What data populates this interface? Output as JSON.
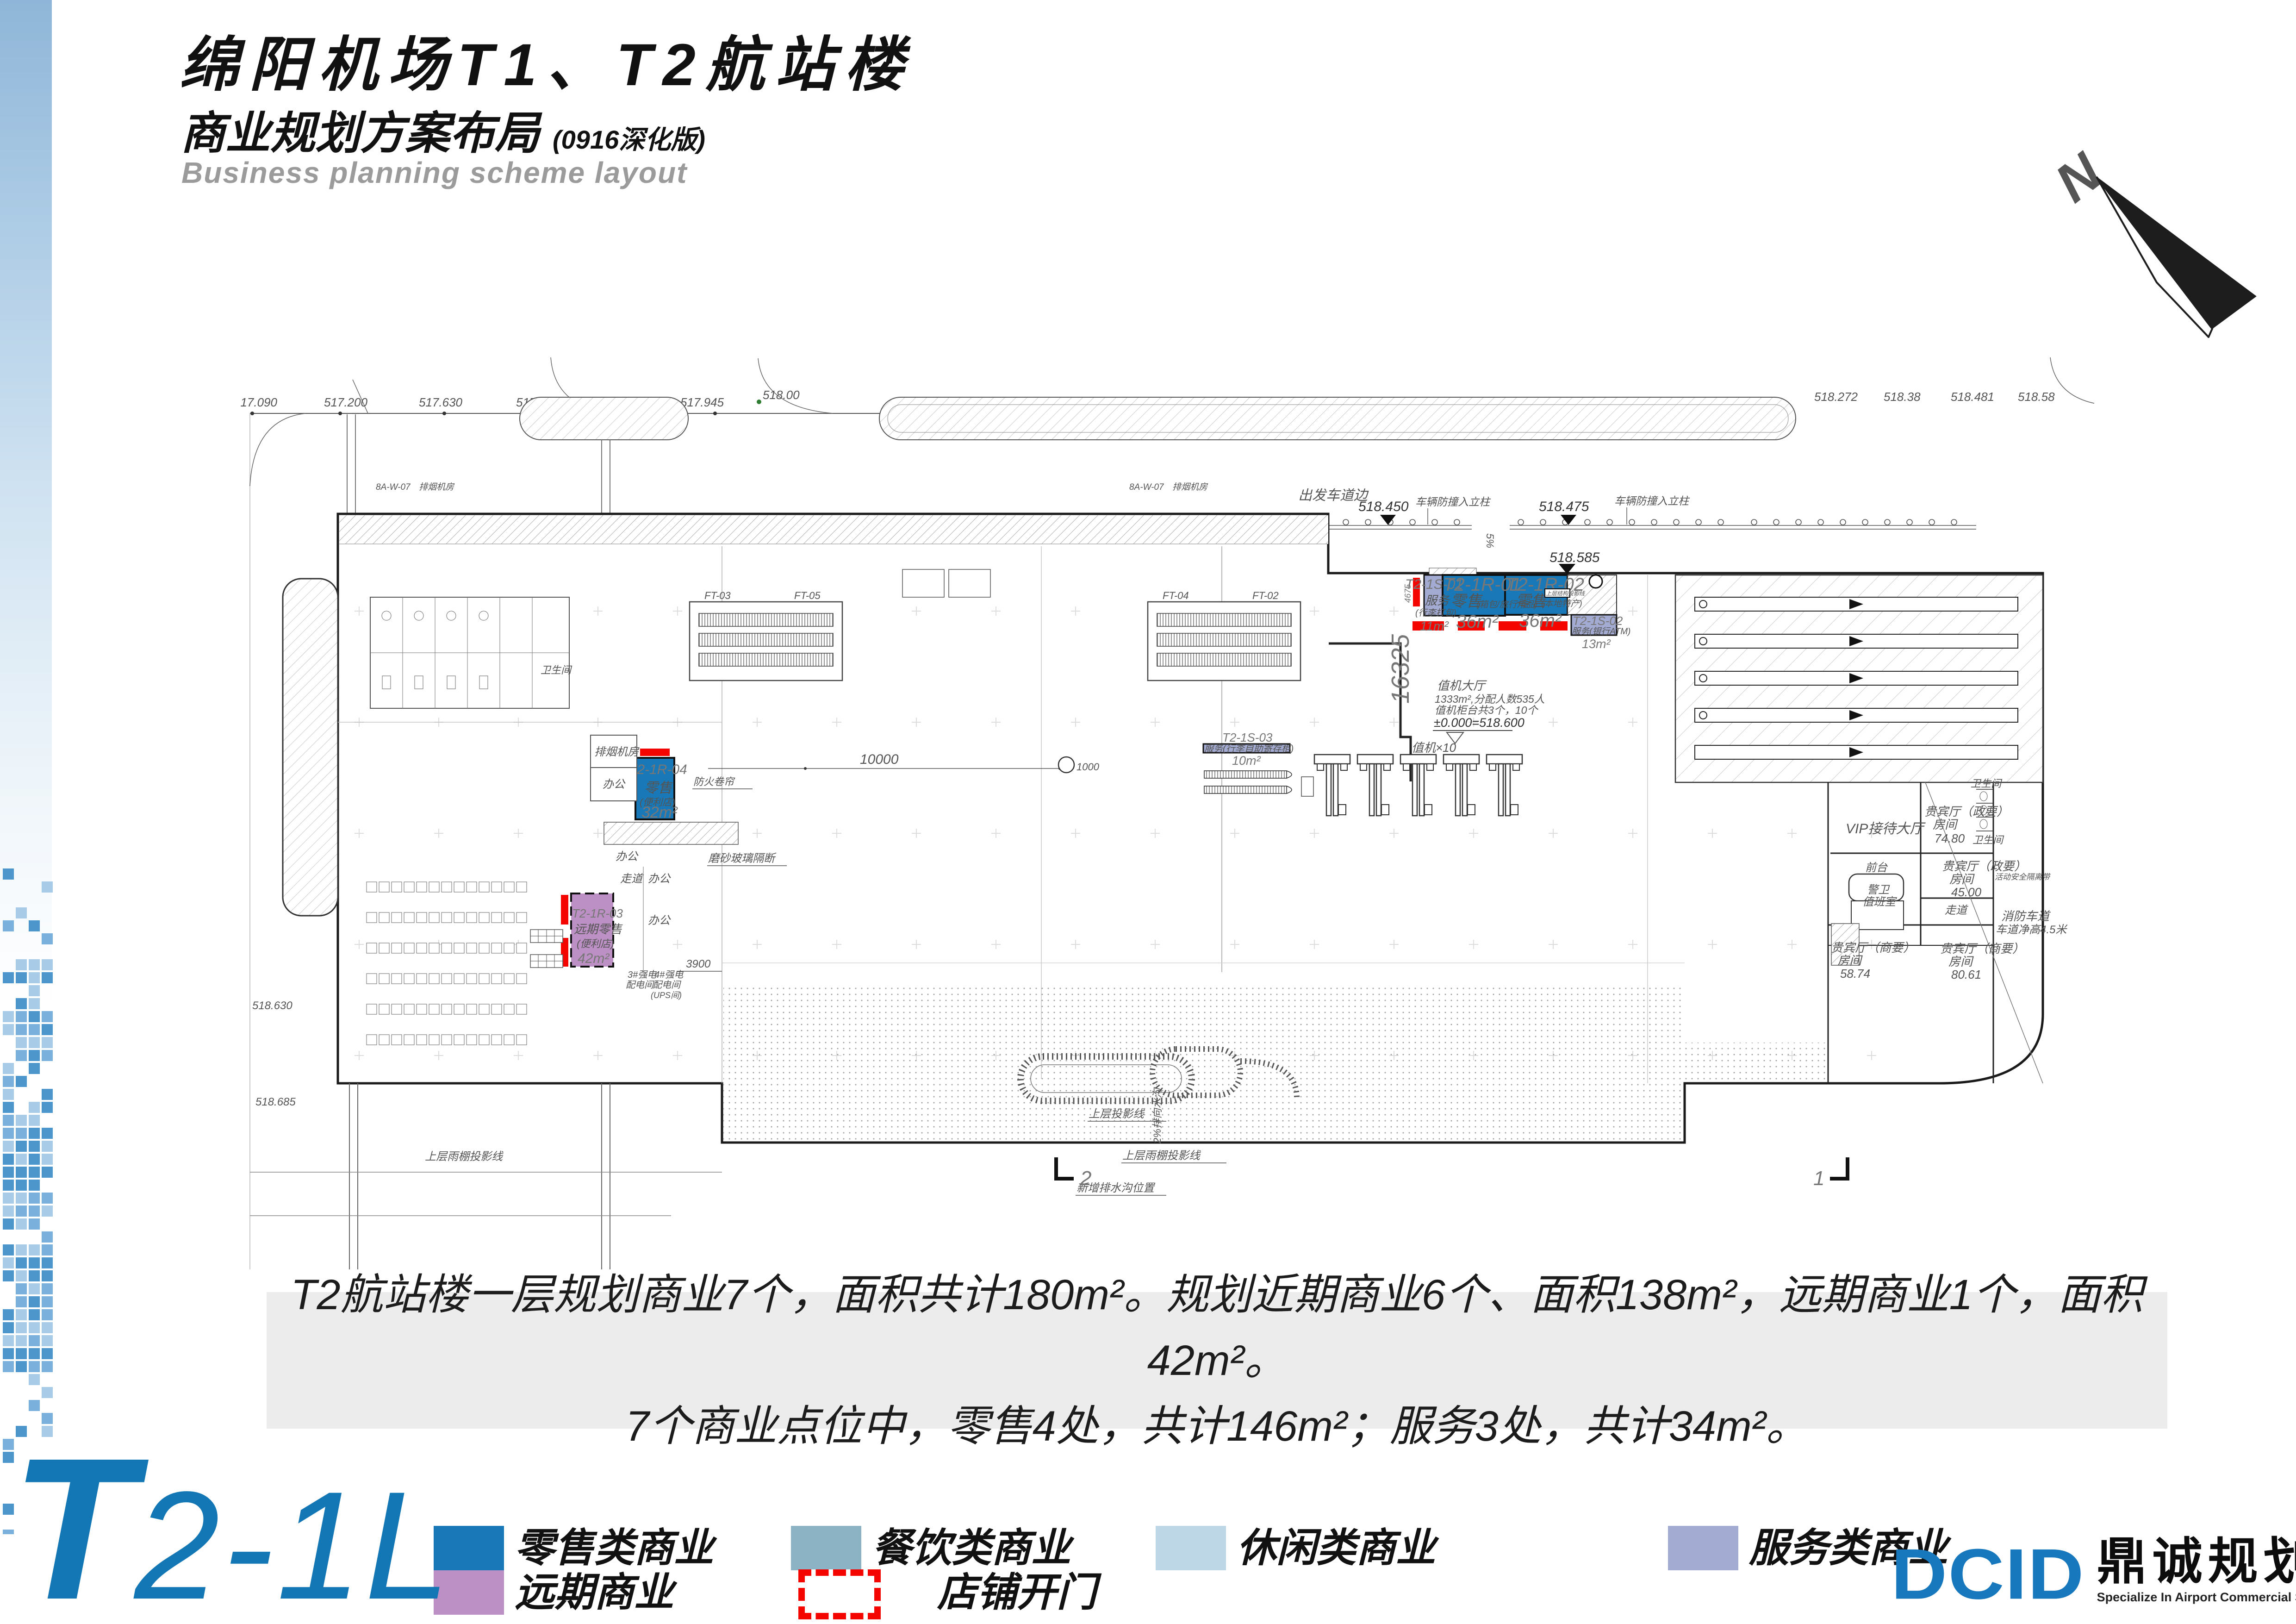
{
  "header": {
    "title": "绵阳机场T1、T2航站楼",
    "subtitle": "商业规划方案布局",
    "subtitle_note": "(0916深化版)",
    "subtitle_en": "Business planning scheme layout",
    "north_label": "N"
  },
  "summary": {
    "line1": "T2航站楼一层规划商业7个，面积共计180m²。规划近期商业6个、面积138m²，远期商业1个，面积42m²。",
    "line2": "7个商业点位中，零售4处，共计146m²；服务3处，共计34m²。"
  },
  "colors": {
    "retail": "#1878B8",
    "dining": "#8CB3C4",
    "leisure": "#BDD7E6",
    "service": "#A3ABD2",
    "longterm": "#BC90C4",
    "open_red": "#F50500",
    "accent_blue": "#1477B5",
    "logo_blue": "#1878BE",
    "elev_green": "#2E7D32"
  },
  "legend": {
    "items": [
      {
        "key": "retail",
        "label": "零售类商业"
      },
      {
        "key": "dining",
        "label": "餐饮类商业"
      },
      {
        "key": "leisure",
        "label": "休闲类商业"
      },
      {
        "key": "service",
        "label": "服务类商业"
      },
      {
        "key": "longterm",
        "label": "远期商业"
      },
      {
        "key": "open",
        "label": "店铺开门"
      }
    ]
  },
  "footer": {
    "floor_code_big": "T",
    "floor_code_rest": "2-1L",
    "logo_text": "DCID",
    "logo_cn": "鼎诚规划设计",
    "logo_en": "Specialize In Airport Commercial Space Planning And Designing"
  },
  "plan": {
    "units": [
      {
        "id": "T2-1S-01",
        "cat": "service",
        "name": "服务",
        "sub": "(行李打包)",
        "area": "11m²"
      },
      {
        "id": "T2-1R-01",
        "cat": "retail",
        "name": "零售",
        "sub": "(箱包/旅行用品)",
        "area": "36m²"
      },
      {
        "id": "T2-1R-02",
        "cat": "retail",
        "name": "零售",
        "sub": "(本地特产)",
        "area": "36m²"
      },
      {
        "id": "T2-1S-02",
        "cat": "service",
        "name": "服务",
        "sub": "(银行ATM)",
        "area": "13m²"
      },
      {
        "id": "T2-1S-03",
        "cat": "service",
        "name": "服务",
        "sub": "(行李自助寄存柜)",
        "area": "10m²"
      },
      {
        "id": "T2-1R-04",
        "cat": "retail",
        "name": "零售",
        "sub": "(便利店)",
        "area": "32m²"
      },
      {
        "id": "T2-1R-03",
        "cat": "longterm",
        "name": "远期零售",
        "sub": "(便利店)",
        "area": "42m²"
      }
    ],
    "labels": {
      "elev_517_090": "517.090",
      "elev_517_200": "517.200",
      "elev_517_630": "517.630",
      "elev_517_735": "517.735",
      "elev_517_945": "517.945",
      "elev_518_00": "518.00",
      "elev_518_272": "518.272",
      "elev_518_38": "518.38",
      "elev_518_481": "518.481",
      "elev_518_58": "518.58",
      "elev_518_450": "518.450",
      "elev_518_475": "518.475",
      "elev_518_585": "518.585",
      "elev_518_630": "518.630",
      "elev_518_685": "518.685",
      "dim_16325": "16325",
      "dim_10000": "10000",
      "dim_3900": "3900",
      "dim_4675": "4675",
      "dim_1000": "1000",
      "dim_5pct": "5%",
      "curb": "出发车道边",
      "bollard": "车辆防撞入立柱",
      "fire_shutter": "防火卷帘",
      "glass": "磨砂玻璃隔断",
      "proj_line": "上层投影线",
      "canopy_proj": "上层雨棚投影线",
      "drain2": "2%排向水沟",
      "new_drain": "新增排水沟位置",
      "level0": "±0.000=518.600",
      "checkin_hall": "值机大厅",
      "checkin_stats": "1333m²,分配人数535人",
      "checkin_counts": "值机柜台共3个，10个",
      "checkin10": "值机×10",
      "upper_note": "上层结构投影线",
      "smoke": "排烟机房",
      "office": "办公",
      "corridor": "走道",
      "power3": "3#强电",
      "power4": "4#强电",
      "power_room": "配电间",
      "ups": "(UPS间)",
      "toilet": "卫生间",
      "vip_hall": "VIP接待大厅",
      "desk": "前台",
      "guard1": "警卫",
      "guard2": "值班室",
      "vip_gov": "贵宾厅（政要）",
      "vip_biz": "贵宾厅（商要）",
      "room": "房间",
      "a7480": "74.80",
      "a4500": "45.00",
      "a8061": "80.61",
      "a5874": "58.74",
      "fire_lane1": "消防车道",
      "fire_lane2": "车道净高4.5米",
      "barrier": "活动安全隔离带",
      "ft02": "FT-02",
      "ft03": "FT-03",
      "ft04": "FT-04",
      "ft05": "FT-05",
      "grid_ref": "8A-W-07",
      "sec2": "2",
      "sec1": "1"
    }
  }
}
